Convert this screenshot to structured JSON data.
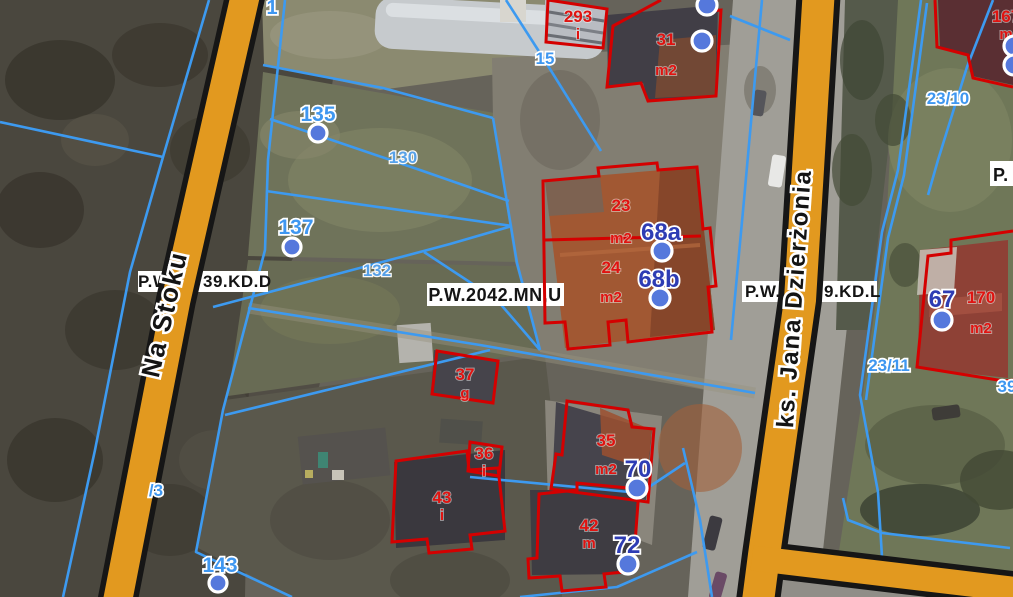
{
  "colors": {
    "road_fill": "#e2991f",
    "road_border": "#161616",
    "parcel_line": "#3d9af0",
    "building_outline": "#d40000",
    "parcel_number_blue": "#3f97f0",
    "address_number_blue": "#2e3cb4",
    "building_label_red": "#e01310",
    "marker_fill": "#5578dc",
    "plan_label_bg": "#ffffff"
  },
  "streets": [
    {
      "name": "Na Stoku",
      "x": 173,
      "y": 316,
      "rotate": -77,
      "size": 26
    },
    {
      "name": "ks. Jana Dzierżonia",
      "x": 802,
      "y": 299,
      "rotate": -86,
      "size": 24
    }
  ],
  "plan_labels": [
    {
      "id": "kdd",
      "rect": [
        138,
        271,
        130,
        21
      ],
      "baseline": 287,
      "size": 17,
      "layer": "under",
      "fragments": [
        {
          "text": "P.W",
          "x": 138,
          "anchor": "start"
        },
        {
          "text": "39.KD.D",
          "x": 203,
          "anchor": "start"
        }
      ]
    },
    {
      "id": "kdl",
      "rect": [
        742,
        281,
        135,
        21
      ],
      "baseline": 297,
      "size": 17,
      "layer": "under",
      "fragments": [
        {
          "text": "P.W.",
          "x": 745,
          "anchor": "start"
        },
        {
          "text": "9.KD.L",
          "x": 824,
          "anchor": "start"
        }
      ]
    },
    {
      "id": "mnu",
      "rect": [
        427,
        283,
        137,
        23
      ],
      "baseline": 301,
      "size": 18,
      "layer": "over",
      "fragments": [
        {
          "text": "P.W.2042.MN,U",
          "x": 495,
          "anchor": "middle"
        }
      ]
    },
    {
      "id": "p-edge",
      "rect": [
        990,
        161,
        24,
        25
      ],
      "baseline": 181,
      "size": 18,
      "layer": "over",
      "fragments": [
        {
          "text": "P.",
          "x": 993,
          "anchor": "start"
        }
      ]
    }
  ],
  "parcel_numbers": [
    {
      "text": "1",
      "x": 272,
      "y": 14,
      "size": 20,
      "light": false
    },
    {
      "text": "135",
      "x": 318,
      "y": 121,
      "size": 21,
      "light": false
    },
    {
      "text": "137",
      "x": 296,
      "y": 234,
      "size": 21,
      "light": false
    },
    {
      "text": "130",
      "x": 403,
      "y": 163,
      "size": 17,
      "light": true
    },
    {
      "text": "132",
      "x": 377,
      "y": 276,
      "size": 17,
      "light": true
    },
    {
      "text": "143",
      "x": 220,
      "y": 572,
      "size": 21,
      "light": false
    },
    {
      "text": "/3",
      "x": 156,
      "y": 496,
      "size": 17,
      "light": false
    },
    {
      "text": "15",
      "x": 545,
      "y": 64,
      "size": 17,
      "light": false
    },
    {
      "text": "23/10",
      "x": 948,
      "y": 104,
      "size": 17,
      "light": false
    },
    {
      "text": "23/11",
      "x": 889,
      "y": 371,
      "size": 17,
      "light": false
    },
    {
      "text": "39",
      "x": 1007,
      "y": 392,
      "size": 17,
      "light": false
    }
  ],
  "parcel_markers": [
    {
      "x": 318,
      "y": 133
    },
    {
      "x": 292,
      "y": 247
    },
    {
      "x": 218,
      "y": 583
    }
  ],
  "address_points": [
    {
      "number": "68a",
      "tx": 661,
      "ty": 240,
      "mx": 662,
      "my": 251
    },
    {
      "number": "68b",
      "tx": 659,
      "ty": 287,
      "mx": 660,
      "my": 298
    },
    {
      "number": "70",
      "tx": 638,
      "ty": 477,
      "mx": 637,
      "my": 488
    },
    {
      "number": "72",
      "tx": 627,
      "ty": 553,
      "mx": 628,
      "my": 564
    },
    {
      "number": "67",
      "tx": 942,
      "ty": 307,
      "mx": 942,
      "my": 320
    }
  ],
  "unlabeled_markers": [
    {
      "x": 707,
      "y": 5
    },
    {
      "x": 702,
      "y": 41
    },
    {
      "x": 1014,
      "y": 46
    },
    {
      "x": 1014,
      "y": 65
    }
  ],
  "building_labels": [
    {
      "line1": "293",
      "line2": "i",
      "x": 578,
      "y1": 22,
      "y2": 39
    },
    {
      "line1": "31",
      "line2": "m2",
      "x": 666,
      "y1": 45,
      "y2": 75
    },
    {
      "line1": "23",
      "line2": "m2",
      "x": 621,
      "y1": 211,
      "y2": 243
    },
    {
      "line1": "24",
      "line2": "m2",
      "x": 611,
      "y1": 273,
      "y2": 302
    },
    {
      "line1": "37",
      "line2": "g",
      "x": 465,
      "y1": 380,
      "y2": 398
    },
    {
      "line1": "36",
      "line2": "i",
      "x": 484,
      "y1": 459,
      "y2": 476
    },
    {
      "line1": "43",
      "line2": "i",
      "x": 442,
      "y1": 503,
      "y2": 520
    },
    {
      "line1": "35",
      "line2": "m2",
      "x": 606,
      "y1": 446,
      "y2": 474
    },
    {
      "line1": "42",
      "line2": "m",
      "x": 589,
      "y1": 531,
      "y2": 548
    },
    {
      "line1": "170",
      "line2": "m2",
      "x": 981,
      "y1": 303,
      "y2": 333
    },
    {
      "line1": "167",
      "line2": "m",
      "x": 1006,
      "y1": 22,
      "y2": 39
    }
  ]
}
